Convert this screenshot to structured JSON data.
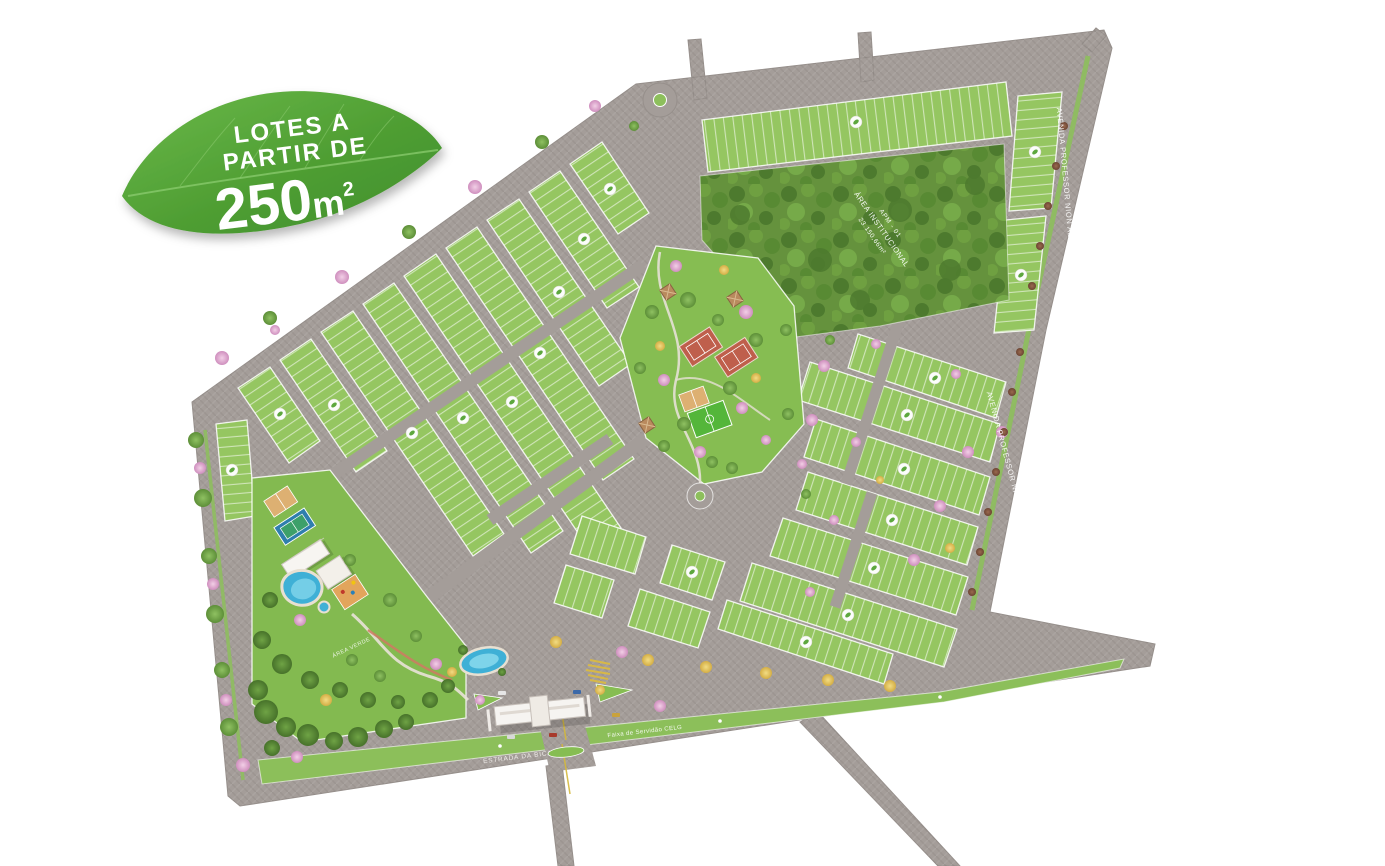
{
  "promo_badge": {
    "line1": "LOTES A",
    "line2": "PARTIR DE",
    "area_value": "250",
    "area_unit": "m",
    "area_sup": "2"
  },
  "map_labels": {
    "avenue_name": "AVENIDA PROFESSOR NION ALBERNAZ",
    "institutional_area_code": "APM - 01",
    "institutional_area_name": "ÁREA INSTITUCIONAL",
    "institutional_area_size": "23.150,66m²",
    "easement_label": "Faixa de Servidão CELG",
    "access_road_name": "ESTRADA DA BICA",
    "club_green_area": "ÁREA VERDE"
  },
  "colors": {
    "leaf_green": "#58A83C",
    "lot_green": "#95C661",
    "road_gray": "#A49D99",
    "forest_green": "#65923D",
    "water_blue": "#3FB0D6",
    "court_clay": "#BF5F4C",
    "sand_tan": "#DDB072",
    "flower_pink": "#E3B7D8",
    "flower_yellow": "#E8D36A"
  }
}
